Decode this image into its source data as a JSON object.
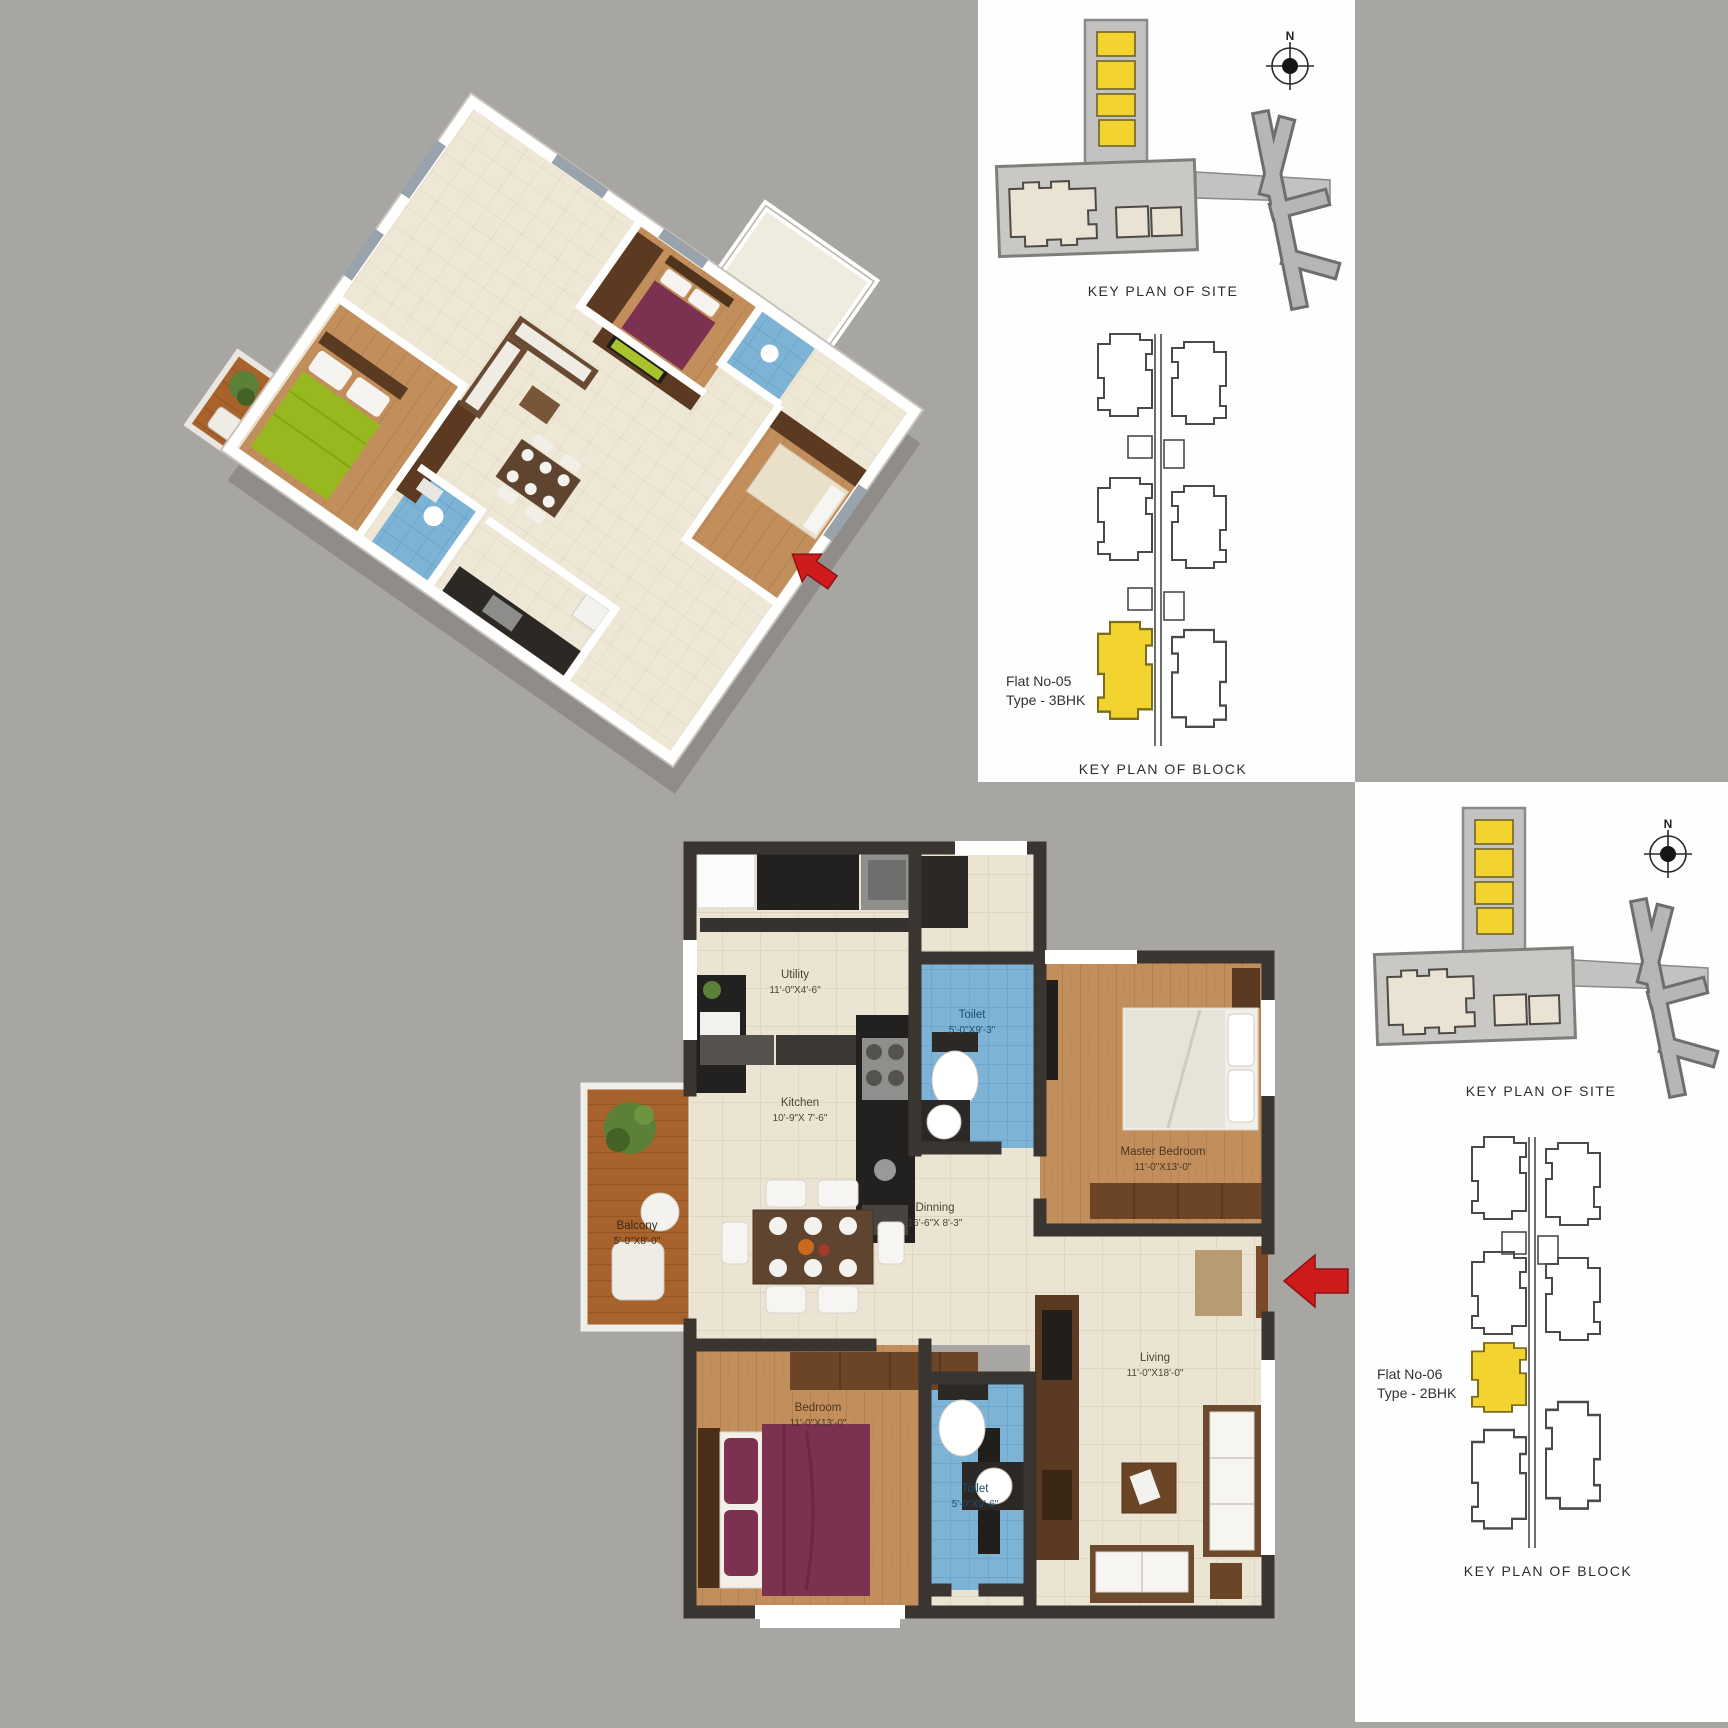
{
  "page": {
    "background_color": "#a8a6a3",
    "accent_yellow": "#f3d32f",
    "arrow_red": "#cf1b1b"
  },
  "key_panels": {
    "flat05": {
      "site_title": "KEY PLAN OF SITE",
      "block_title": "KEY PLAN OF BLOCK",
      "flat_no": "Flat No-05",
      "flat_type": "Type - 3BHK",
      "compass": "N"
    },
    "flat06": {
      "site_title": "KEY PLAN OF SITE",
      "block_title": "KEY PLAN OF BLOCK",
      "flat_no": "Flat No-06",
      "flat_type": "Type - 2BHK",
      "compass": "N"
    }
  },
  "floor_plan": {
    "rooms": {
      "utility": {
        "name": "Utility",
        "dims": "11'-0\"X4'-6\""
      },
      "toilet_top": {
        "name": "Toilet",
        "dims": "5'-0\"X9'-3\""
      },
      "kitchen": {
        "name": "Kitchen",
        "dims": "10'-9\"X 7'-6\""
      },
      "master_bedroom": {
        "name": "Master Bedroom",
        "dims": "11'-0\"X13'-0\""
      },
      "dinning": {
        "name": "Dinning",
        "dims": "16'-6\"X 8'-3\""
      },
      "balcony": {
        "name": "Balcony",
        "dims": "5'-0\"X8'-0\""
      },
      "bedroom": {
        "name": "Bedroom",
        "dims": "11'-0\"X13'-0\""
      },
      "toilet_bottom": {
        "name": "Toilet",
        "dims": "5'-0\"X9'-6\""
      },
      "living": {
        "name": "Living",
        "dims": "11'-0\"X18'-0\""
      }
    }
  }
}
